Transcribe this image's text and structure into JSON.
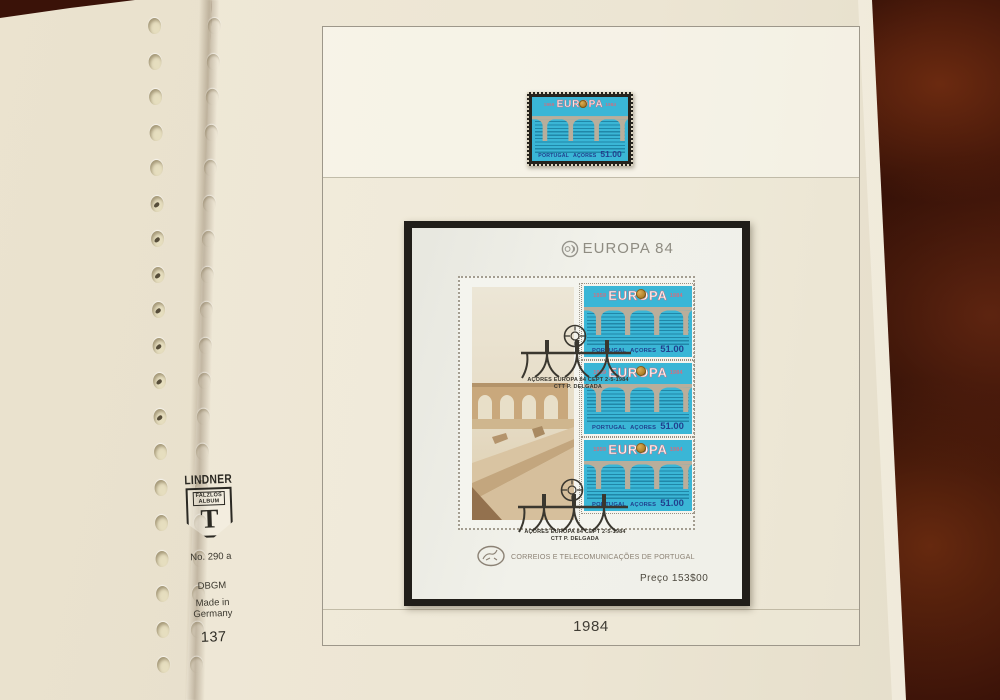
{
  "album": {
    "brand": "LINDNER",
    "shield": {
      "line1": "FALZLOS",
      "line2": "ALBUM",
      "letter": "T"
    },
    "ref_no": "No. 290 a",
    "dbgm": "DBGM",
    "made_in_line1": "Made in",
    "made_in_line2": "Germany",
    "page_number": "137"
  },
  "page": {
    "year_label": "1984"
  },
  "single_stamp": {
    "year_left": "1959",
    "title": "EUROPA",
    "year_right": "1984",
    "country": "PORTUGAL",
    "region": "AÇORES",
    "value": "51.00"
  },
  "sheet": {
    "title": "EUROPA 84",
    "stamps": [
      {
        "year_left": "1959",
        "title": "EUROPA",
        "year_right": "1984",
        "country": "PORTUGAL",
        "region": "AÇORES",
        "value": "51.00"
      },
      {
        "year_left": "1959",
        "title": "EUROPA",
        "year_right": "1984",
        "country": "PORTUGAL",
        "region": "AÇORES",
        "value": "51.00"
      },
      {
        "year_left": "1959",
        "title": "EUROPA",
        "year_right": "1984",
        "country": "PORTUGAL",
        "region": "AÇORES",
        "value": "51.00"
      }
    ],
    "postmarks": [
      {
        "line1": "AÇORES  EUROPA 84  CEPT  2-5-1984",
        "line2": "CTT P. DELGADA"
      },
      {
        "line1": "AÇORES  EUROPA 84  CEPT  2-5-1984",
        "line2": "CTT P. DELGADA"
      }
    ],
    "operator": "CORREIOS E TELECOMUNICAÇÕES DE PORTUGAL",
    "price": "Preço  153$00"
  },
  "colors": {
    "stamp_cyan": "#3ab6d6",
    "stamp_text_blue": "#21418e",
    "europa_pink": "#cf6f80",
    "cept_gold": "#bd8a2e",
    "page_cream": "#ece5d3",
    "mount_black": "#211e19",
    "table_brown": "#3a1208"
  }
}
